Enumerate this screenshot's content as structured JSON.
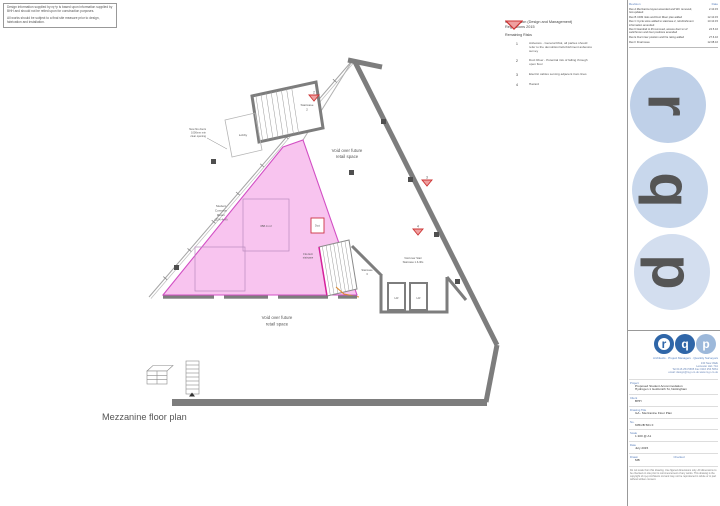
{
  "drawing_title": "Mezzanine floor plan",
  "notes": {
    "para1": "Design information supplied by rq+p is based upon information supplied by BHH and should not be relied upon for construction purposes.",
    "para2": "All works should be subject to a final site measure prior to design, fabrication and installation."
  },
  "cdm_key": {
    "title1": "Construction (Design and Management)",
    "title2": "Regulations 2015",
    "subtitle": "Remaining Risks",
    "items": [
      {
        "num": "1",
        "text": "Asbestos - General Risk, all parties should refer to the demolition/refurbishment asbestos survey"
      },
      {
        "num": "2",
        "text": "Duct Riser - Potential risk of falling through open floor"
      },
      {
        "num": "3",
        "text": "Electric cables serving adjacent tram lines"
      },
      {
        "num": "4",
        "text": "Hazard"
      }
    ]
  },
  "revisions": {
    "header_revision": "Revision",
    "header_date": "Date",
    "rows": [
      {
        "note": "Rev A  Mezzanine layout amended and WC removed, GA updated",
        "date": "2.10.15"
      },
      {
        "note": "Rev B  CDM risks and Duct Riser plan added",
        "date": "12.10.15"
      },
      {
        "note": "Rev C  Cycle store added to staircase 2, refurbishment information amended",
        "date": "13.10.15"
      },
      {
        "note": "Rev D  Handrail to lift removed, access door to LV switchroom and riser positions amended",
        "date": "24.5.16"
      },
      {
        "note": "Rev E  Duct riser position and fire rating added",
        "date": "27.6.16"
      },
      {
        "note": "Rev F  Final issue",
        "date": "12.08.16"
      }
    ]
  },
  "plan": {
    "void_upper_l1": "Void over future",
    "void_upper_l2": "retail space",
    "void_lower_l1": "Void over future",
    "void_lower_l2": "retail space",
    "staircase2_l1": "Staircase",
    "staircase2_l2": "2",
    "staircase3_l1": "Staircase",
    "staircase3_l2": "3",
    "lobby": "Lobby",
    "fire_note_l1": "New fire doors",
    "fire_note_l2": "1000mm min",
    "fire_note_l3": "clear opening",
    "common_l1": "Student",
    "common_l2": "Common",
    "common_l3": "Room",
    "common_l4": "(224.4m²)",
    "area_value": "358.4 m²",
    "void_stair_l1": "Void over Stair",
    "void_stair_l2": "Staircase 1 & lifts",
    "fire_exit_l1": "Fire Exit",
    "fire_exit_l2": "staircase",
    "duct": "Duct",
    "lift_left": "LR",
    "lift_right": "LR",
    "hz2": "2",
    "hz3": "3",
    "hz4": "4"
  },
  "watermark": {
    "l1": "r",
    "l2": "q",
    "l3": "p"
  },
  "logo": {
    "l1": "r",
    "l2": "q",
    "l3": "p"
  },
  "firm": {
    "line": "Architects · Project Managers · Quantity Surveyors",
    "addr1": "130 New Walk",
    "addr2": "Leicester LE1 7JA",
    "addr3": "Tel 0116 254 5665  Fax 0116 254 5661",
    "addr4": "email: design@rq-p.co.uk  www.rq-p.co.uk"
  },
  "tb": {
    "project_label": "Project",
    "project_v1": "Proposed Student Accommodation",
    "project_v2": "Hydrogen 1 Goldsmith St, Nottingham",
    "client_label": "Client",
    "client_v": "BHH",
    "dwg_label": "Drawing Title",
    "dwg_v": "GA - Mezzanine Floor Plan",
    "no_label": "No.",
    "no_v": "6051/B 501 F",
    "scale_label": "Scale",
    "scale_v": "1:100 @ A1",
    "date_label": "Date",
    "date_v": "July 2015",
    "drawn_label": "Drawn",
    "drawn_v": "MB",
    "checked_label": "Checked",
    "checked_v": "",
    "disclaimer": "Do not scale from this drawing. Use figured dimensions only. All dimensions to be checked on site prior to commencement of any works. This drawing is the copyright of rq+p Architects Ltd and may not be reproduced in whole or in part without written consent."
  },
  "colors": {
    "room_pink": "#f8c4ef",
    "room_pink_border": "#d24fc4",
    "wall_gray": "#7d7d7d",
    "hazard_red": "#cc3333",
    "hazard_fill": "#efa0a0",
    "logo_blue": "#2f66a8",
    "watermark_blue": "#c8d7ec",
    "label_blue": "#5b80bd"
  }
}
